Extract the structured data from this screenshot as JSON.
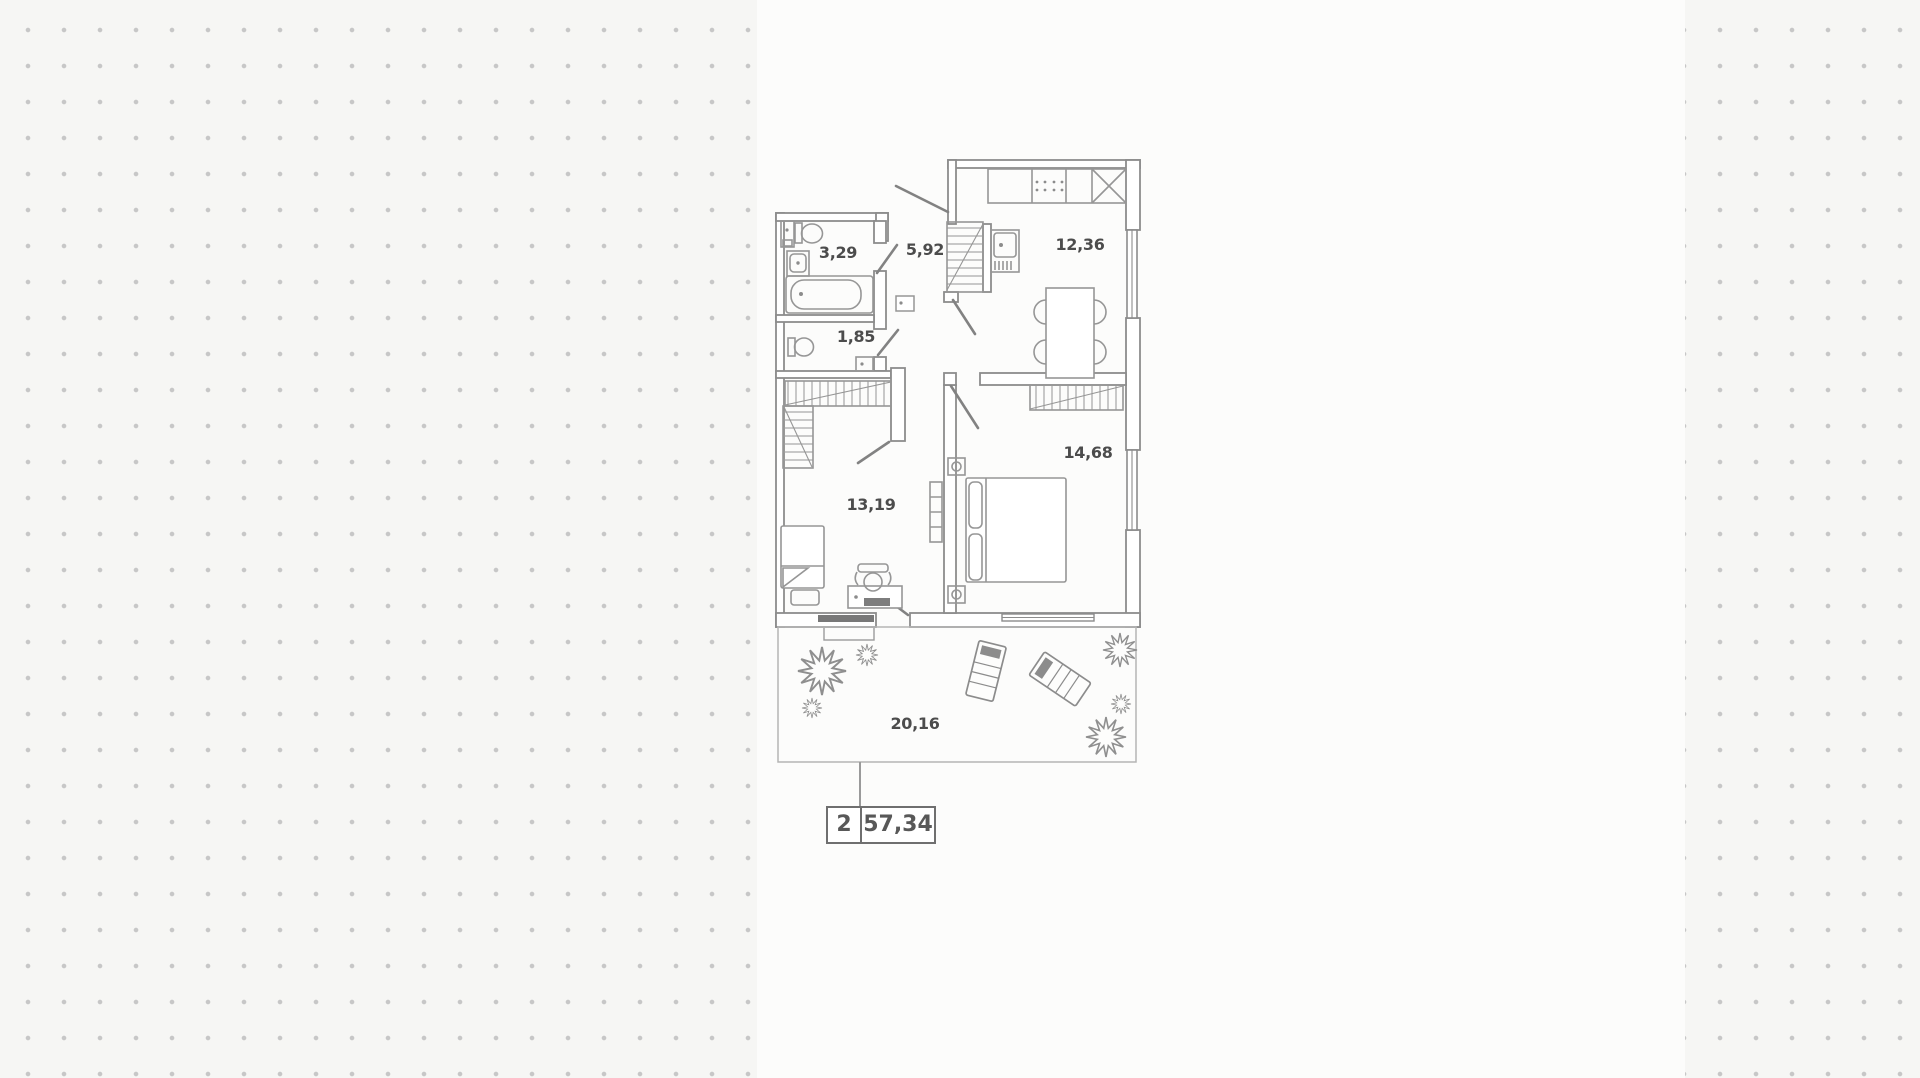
{
  "page": {
    "background_color": "#f6f6f4",
    "dot_color": "#c7c7c7",
    "panel_color": "#fcfcfb"
  },
  "plan": {
    "wall_color": "#8c8c8c",
    "furniture_color": "#969696",
    "label_color": "#4c4c4c",
    "rooms": [
      {
        "key": "bathroom",
        "area_label": "3,29"
      },
      {
        "key": "hallway",
        "area_label": "5,92"
      },
      {
        "key": "kitchen",
        "area_label": "12,36"
      },
      {
        "key": "wc",
        "area_label": "1,85"
      },
      {
        "key": "living-room",
        "area_label": "13,19"
      },
      {
        "key": "bedroom",
        "area_label": "14,68"
      },
      {
        "key": "terrace",
        "area_label": "20,16"
      }
    ],
    "summary": {
      "rooms_count": "2",
      "total_area": "57,34"
    }
  }
}
